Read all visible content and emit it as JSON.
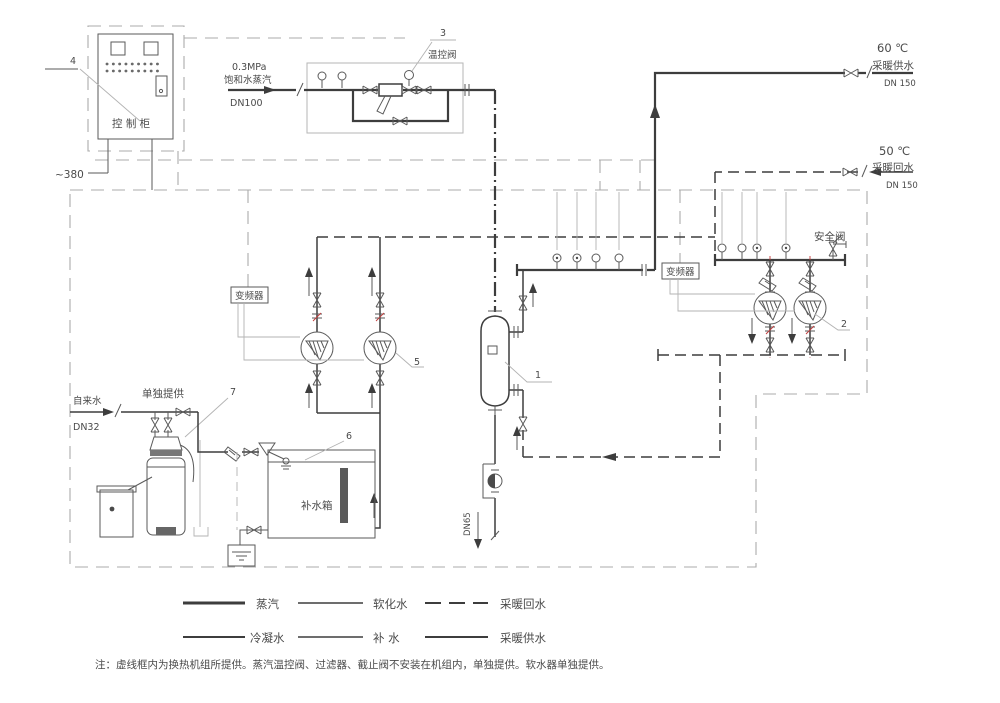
{
  "colors": {
    "line": "#3d3d3d",
    "thin": "#5a5a5a",
    "boundary": "#ababab",
    "signal": "#b3b3b3",
    "accent_red": "#c33a3a",
    "text": "#4a4a4a",
    "background": "#ffffff"
  },
  "cabinet": {
    "label": "控 制 柜",
    "tag": "4",
    "power": "~380"
  },
  "steam": {
    "pressure": "0.3MPa",
    "medium": "饱和水蒸汽",
    "dn": "DN100",
    "valve_tag": "3",
    "valve_name": "温控阀"
  },
  "supply": {
    "temp": "60 ℃",
    "name": "采暖供水",
    "dn": "DN 150"
  },
  "return_water": {
    "temp": "50 ℃",
    "name": "采暖回水",
    "dn": "DN 150"
  },
  "tap": {
    "name": "自来水",
    "dn": "DN32",
    "provision": "单独提供"
  },
  "equipment": {
    "hx_tag": "1",
    "right_pumps_tag": "2",
    "left_pumps_tag": "5",
    "tank_tag": "6",
    "softener_tag": "7",
    "tank_label": "补水箱",
    "safety_valve": "安全阀",
    "vfd_left": "变频器",
    "vfd_right": "变频器",
    "condensate_dn": "DN65"
  },
  "legend": {
    "items": [
      {
        "label": "蒸汽",
        "style": "thick-solid"
      },
      {
        "label": "软化水",
        "style": "solid"
      },
      {
        "label": "采暖回水",
        "style": "dashed"
      },
      {
        "label": "冷凝水",
        "style": "solid"
      },
      {
        "label": "补 水",
        "style": "solid"
      },
      {
        "label": "采暖供水",
        "style": "solid"
      }
    ]
  },
  "note": {
    "text": "注：虚线框内为换热机组所提供。蒸汽温控阀、过滤器、截止阀不安装在机组内，单独提供。软水器单独提供。"
  }
}
